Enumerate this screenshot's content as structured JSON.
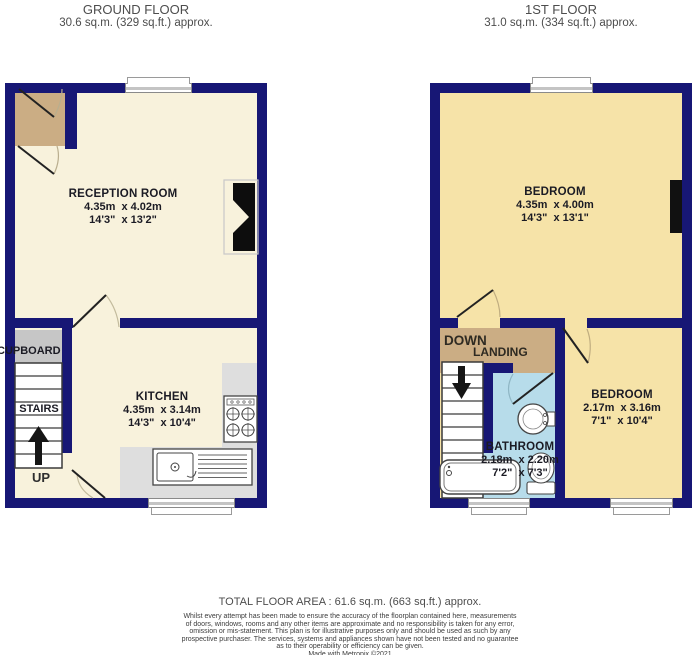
{
  "ground_floor": {
    "title": "GROUND FLOOR",
    "area": "30.6 sq.m. (329 sq.ft.) approx.",
    "reception": {
      "name": "RECEPTION ROOM",
      "metric": "4.35m  x 4.02m",
      "imperial": "14'3\"  x 13'2\""
    },
    "kitchen": {
      "name": "KITCHEN",
      "metric": "4.35m  x 3.14m",
      "imperial": "14'3\"  x 10'4\""
    },
    "cupboard_label": "CUPBOARD",
    "stairs_label": "STAIRS",
    "up_label": "UP"
  },
  "first_floor": {
    "title": "1ST FLOOR",
    "area": "31.0 sq.m. (334 sq.ft.) approx.",
    "bedroom1": {
      "name": "BEDROOM",
      "metric": "4.35m  x 4.00m",
      "imperial": "14'3\"  x 13'1\""
    },
    "bedroom2": {
      "name": "BEDROOM",
      "metric": "2.17m  x 3.16m",
      "imperial": "7'1\"  x 10'4\""
    },
    "bathroom": {
      "name": "BATHROOM",
      "metric": "2.18m  x 2.20m",
      "imperial": "7'2\"  x 7'3\""
    },
    "down_label": "DOWN",
    "landing_label": "LANDING"
  },
  "footer": {
    "total_area": "TOTAL FLOOR AREA : 61.6 sq.m. (663 sq.ft.) approx.",
    "disclaimer_lines": [
      "Whilst every attempt has been made to ensure the accuracy of the floorplan contained here, measurements",
      "of doors, windows, rooms and any other items are approximate and no responsibility is taken for any error,",
      "omission or mis-statement. This plan is for illustrative purposes only and should be used as such by any",
      "prospective purchaser. The services, systems and appliances shown have not been tested and no guarantee",
      "as to their operability or efficiency can be given.",
      "Made with Metropix ©2021"
    ]
  },
  "colors": {
    "wall": "#171775",
    "ground_room_fill": "#F8F2DC",
    "first_room_fill": "#F6E3A8",
    "hall_fill": "#CBAD84",
    "cupboard_fill": "#C6C6C6",
    "counter_fill": "#DEDEDE",
    "bathroom_fill": "#B7DCEA"
  }
}
